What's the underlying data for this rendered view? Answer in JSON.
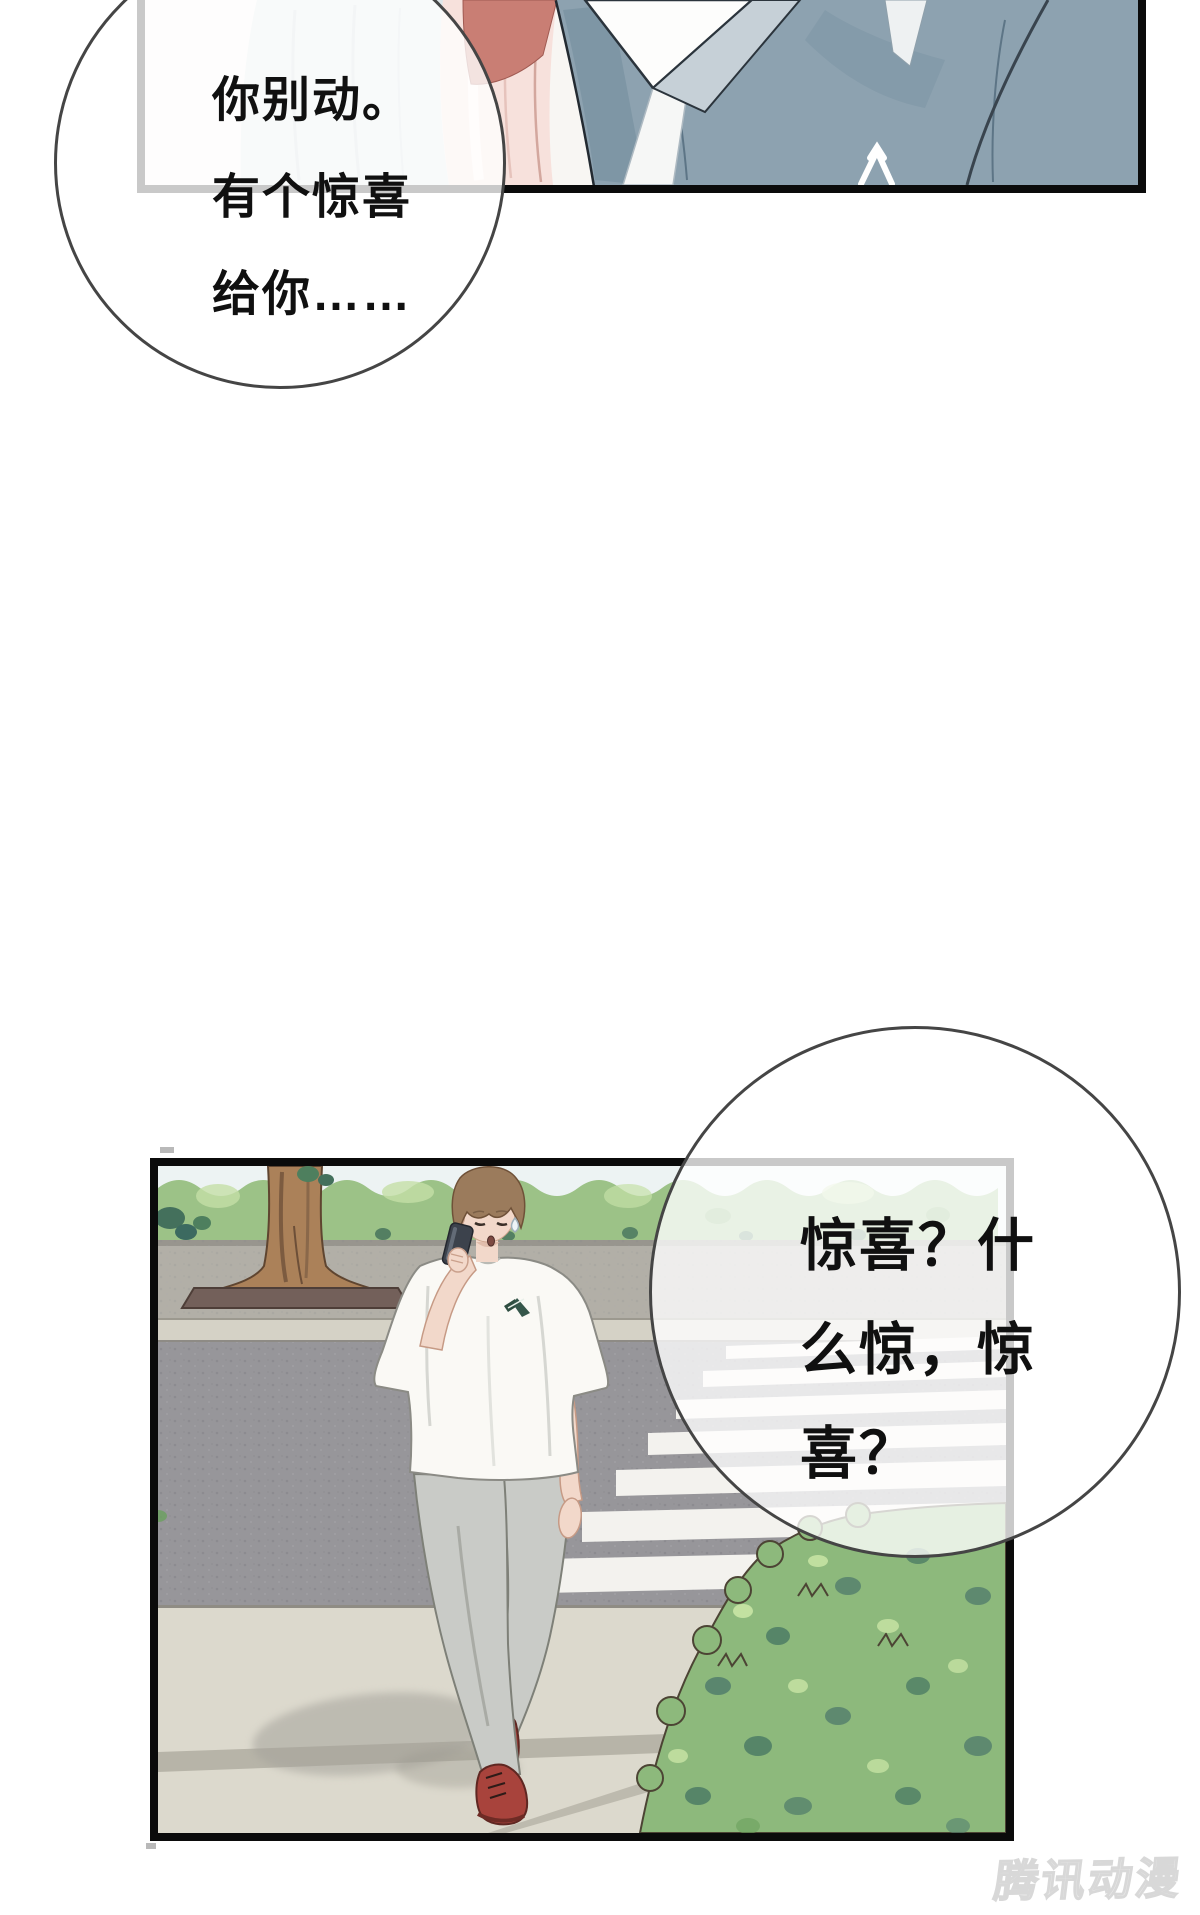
{
  "page": {
    "width": 1200,
    "height": 1915,
    "background": "#ffffff"
  },
  "panels": [
    {
      "name": "panel-closeup-embrace"
    },
    {
      "name": "panel-street-phone-call"
    }
  ],
  "bubbles": [
    {
      "name": "speech-bubble-top",
      "lines": [
        "你别动。",
        "有个惊喜",
        "给你……"
      ],
      "full_text": "你别动。有个惊喜给你……"
    },
    {
      "name": "speech-bubble-bottom",
      "lines": [
        "惊喜？什",
        "么惊，惊",
        "喜？"
      ],
      "full_text": "惊喜？什么惊，惊喜？"
    }
  ],
  "watermark": {
    "text": "腾讯动漫"
  },
  "palette": {
    "panel-border": "#0b0b0b",
    "bubble-stroke": "#454545",
    "text-color": "#101010",
    "watermark-color": "#ececec",
    "sweater": "#8da2b0",
    "sweater-shade": "#7b93a3",
    "collar-white": "#fdfdfc",
    "collar-shade": "#c6d0d7",
    "garment-blue": "#dee6e9",
    "garment-pink": "#f7e1dc",
    "garment-rose": "#c97e74",
    "sky": "#edf3f3",
    "hedge": "#9cc287",
    "hedge-light": "#c4dfa6",
    "hedge-dark": "#46735c",
    "wall": "#b2afa7",
    "far-walk": "#d5d2c6",
    "road": "#97969a",
    "stripe": "#f3f2ee",
    "sidewalk": "#dcd9cd",
    "seam": "#b7b4a8",
    "trunk": "#ab8159",
    "planter": "#73605a",
    "bush": "#8db97c",
    "bush-dark": "#4a7569",
    "bush-light": "#cde8a8",
    "hair": "#9b7b5c",
    "skin": "#f2d8ca",
    "shirt": "#faf9f5",
    "pants": "#c9cbc7",
    "shoes": "#a8433c",
    "phone": "#3c424c"
  }
}
